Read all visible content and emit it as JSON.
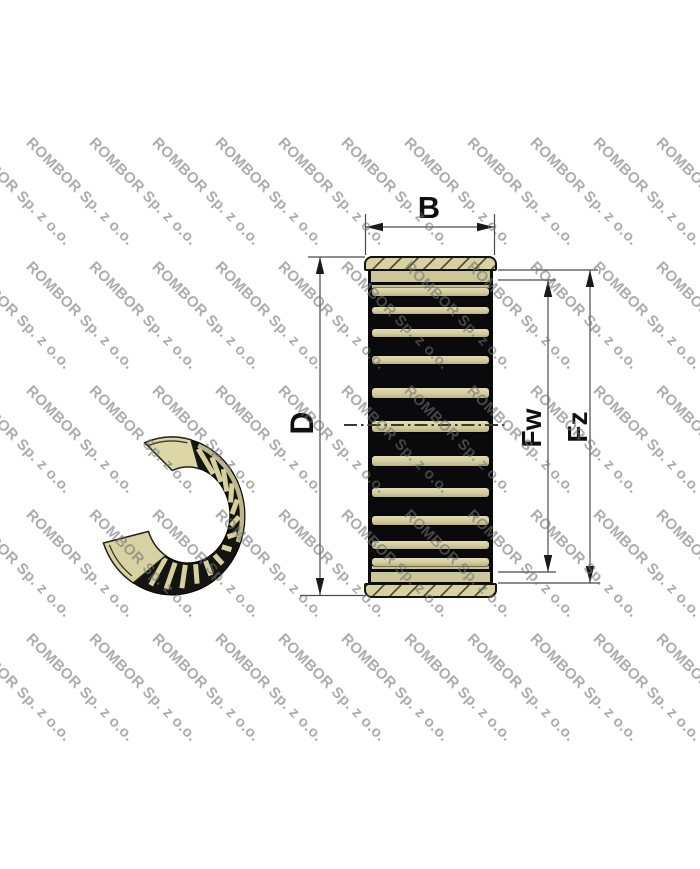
{
  "watermark": {
    "text": "ROMBOR Sp. z o.o."
  },
  "dimension_labels": {
    "b": "B",
    "d": "D",
    "fw": "Fw",
    "fz": "Fz"
  },
  "figure": {
    "views": [
      "3d-split-cage-view",
      "cross-section-view"
    ]
  },
  "colors": {
    "background": "#ffffff",
    "cage_tan": "#d6d09f",
    "cage_dark": "#0c0c0e",
    "hatch_olive": "#3e3a22",
    "watermark_gray": "#8e8e8e",
    "dimension_line": "#4a4a4a"
  }
}
